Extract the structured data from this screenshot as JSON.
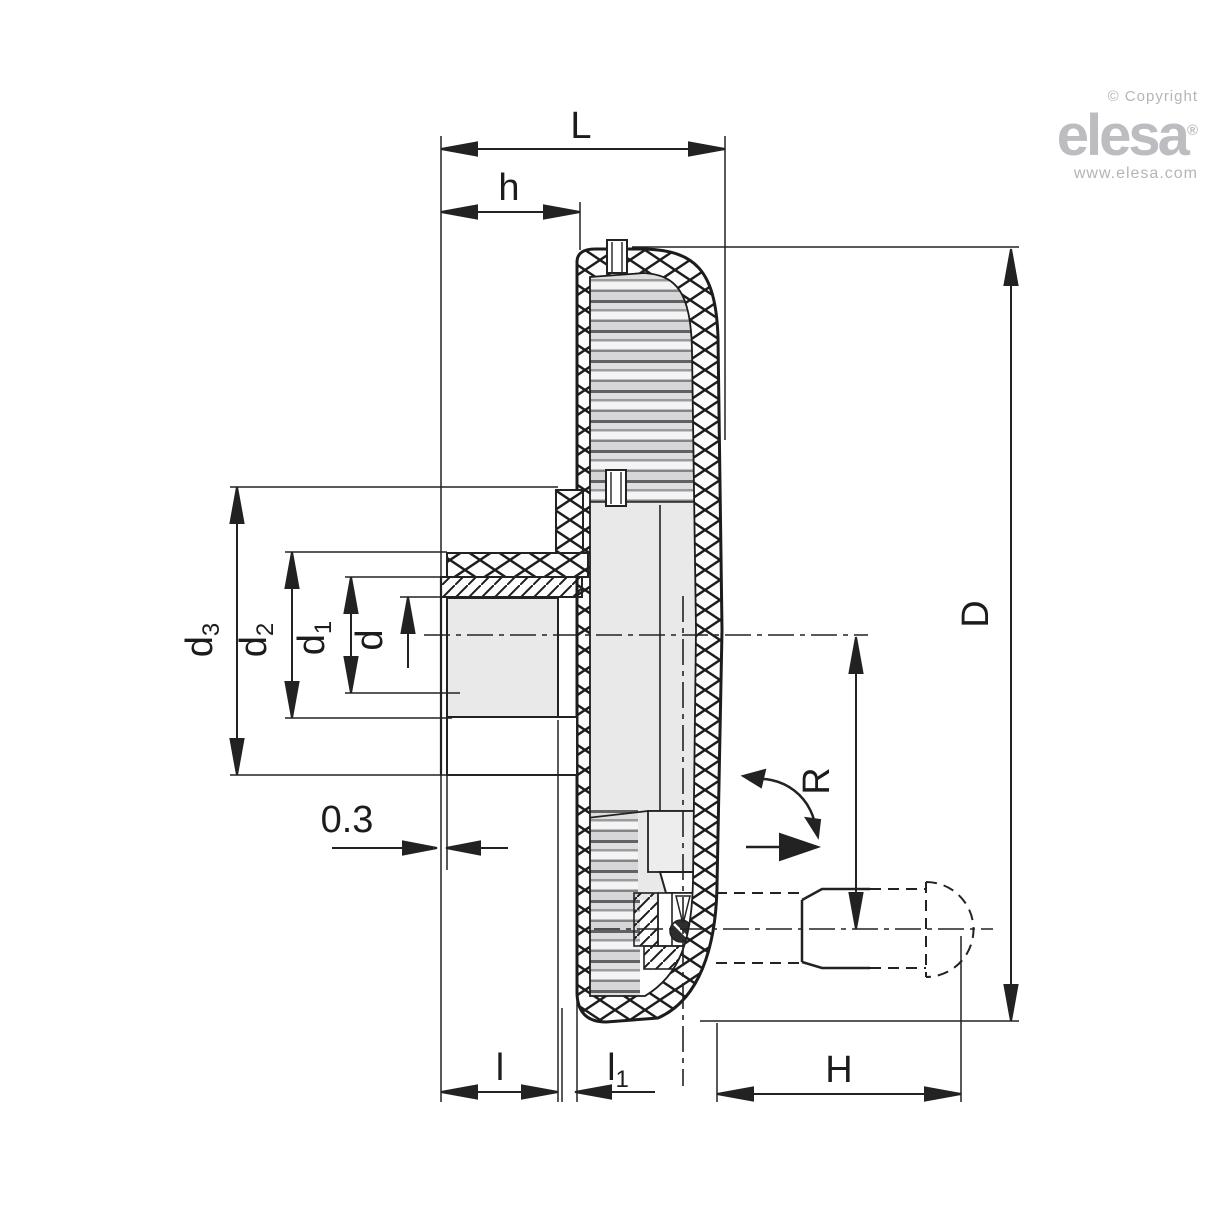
{
  "branding": {
    "copyright": "© Copyright",
    "logo": "elesa",
    "registered": "®",
    "website": "www.elesa.com",
    "brand_color": "#bdbdc1"
  },
  "dims": {
    "L": "L",
    "h": "h",
    "d3_main": "d",
    "d3_sub": "3",
    "d2_main": "d",
    "d2_sub": "2",
    "d1_main": "d",
    "d1_sub": "1",
    "d": "d",
    "offset": "0.3",
    "l": "l",
    "l1_main": "l",
    "l1_sub": "1",
    "H": "H",
    "D": "D",
    "R": "R"
  },
  "colors": {
    "line": "#222222",
    "section_fill": "#e9e9ea",
    "brand_gray": "#bdbdc1"
  }
}
